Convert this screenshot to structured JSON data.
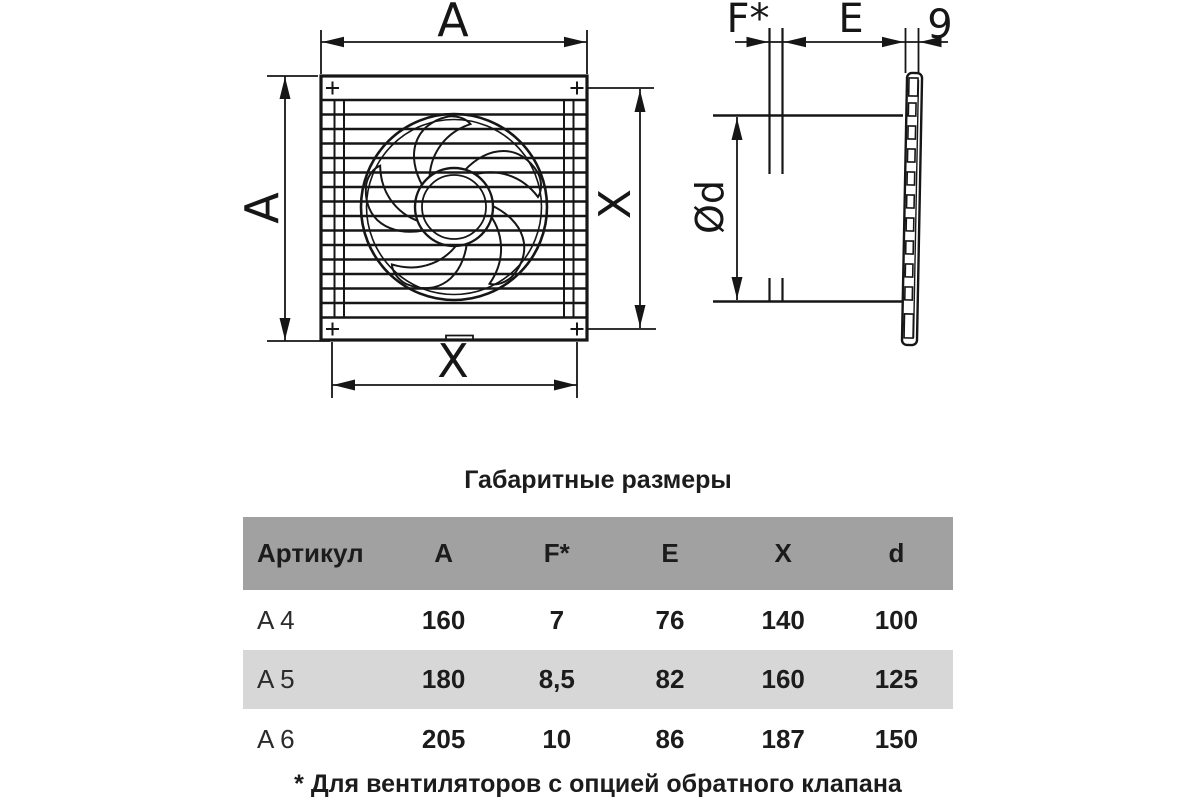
{
  "drawing": {
    "front_view": {
      "dim_width_top": "A",
      "dim_height_left": "A",
      "dim_height_right": "X",
      "dim_width_bottom": "X"
    },
    "side_view": {
      "dim_flange": "F*",
      "dim_depth": "E",
      "dim_grille_thickness": "9",
      "dim_duct_diameter": "Ød"
    }
  },
  "table": {
    "title": "Габаритные размеры",
    "headers": [
      "Артикул",
      "A",
      "F*",
      "E",
      "X",
      "d"
    ],
    "rows": [
      {
        "article": "A 4",
        "values": [
          "160",
          "7",
          "76",
          "140",
          "100"
        ]
      },
      {
        "article": "A 5",
        "values": [
          "180",
          "8,5",
          "82",
          "160",
          "125"
        ]
      },
      {
        "article": "A 6",
        "values": [
          "205",
          "10",
          "86",
          "187",
          "150"
        ]
      }
    ],
    "footnote": "* Для вентиляторов с опцией обратного клапана"
  },
  "colors": {
    "line": "#161616",
    "header_bg": "#a1a1a1",
    "alt_row_bg": "#d7d7d7",
    "text": "#1c1c1c"
  }
}
